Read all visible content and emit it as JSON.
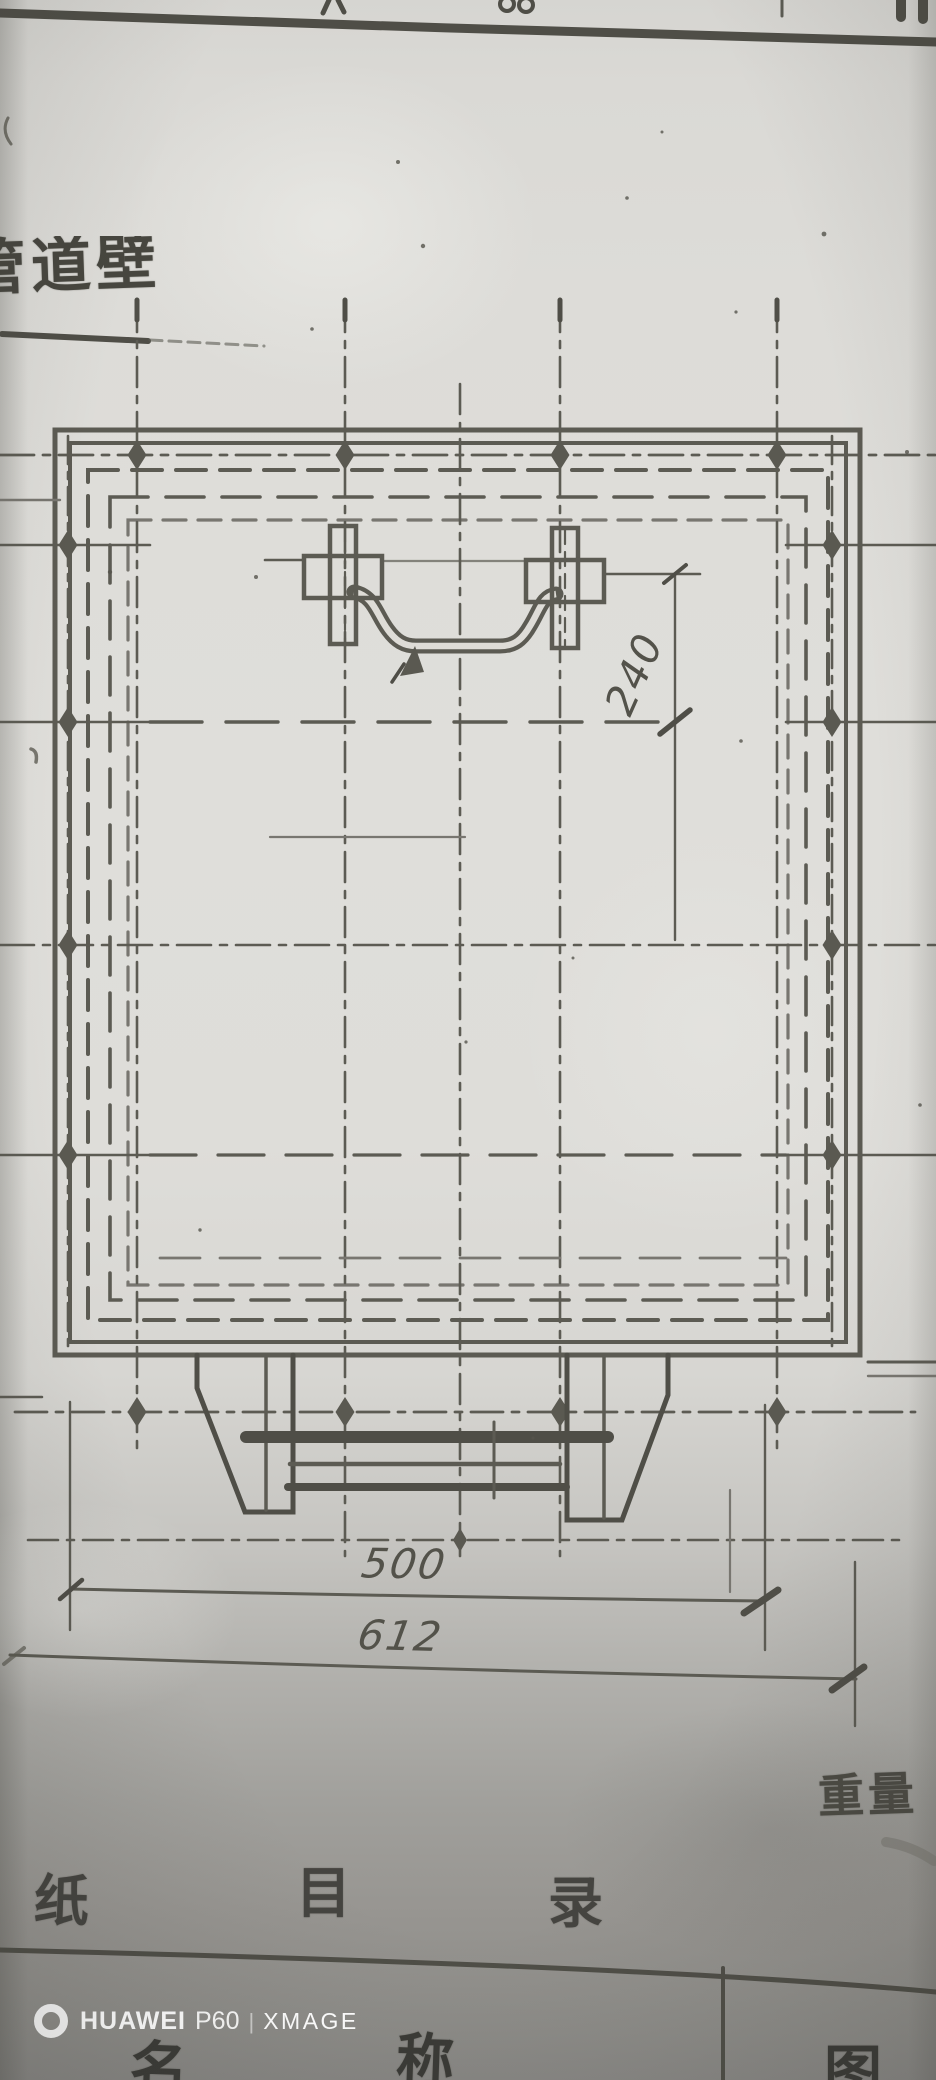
{
  "drawing": {
    "title_partial": "管道壁",
    "dimensions": {
      "handle_offset": "240",
      "bracket_span": "500",
      "overall_width": "612"
    },
    "labels": {
      "weight": "重量"
    },
    "table": {
      "catalog_row": {
        "c1": "纸",
        "c2": "目",
        "c3": "录"
      },
      "name_row": {
        "c1": "名",
        "c2": "称",
        "c3": "图"
      }
    }
  },
  "photo": {
    "device_watermark": {
      "brand": "HUAWEI",
      "model": "P60",
      "separator": "|",
      "engine": "XMAGE"
    }
  },
  "colors": {
    "ink": "#5c5b53",
    "ink_strong": "#4f4e47",
    "paper": "#dedcd7",
    "paper_shadow": "#8f8e8a",
    "watermark": "#ffffff"
  }
}
